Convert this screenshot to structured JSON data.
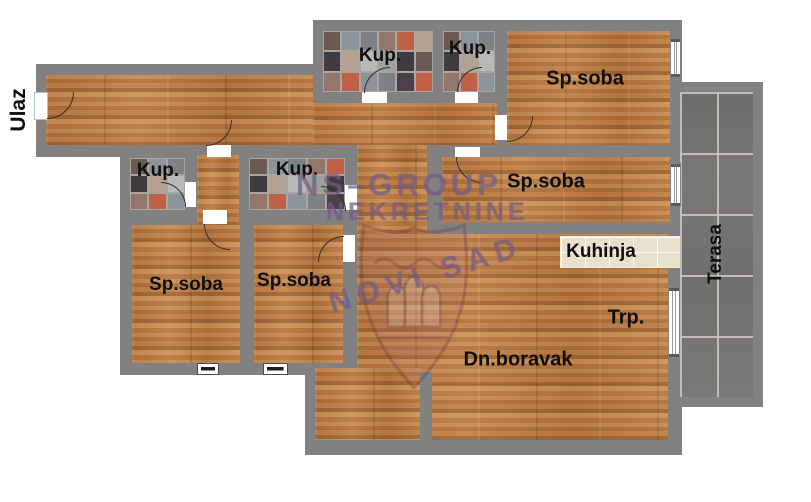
{
  "plan": {
    "labels": {
      "entrance": "Ulaz",
      "bath_top_left": "Kup.",
      "bath_top_right": "Kup.",
      "bedroom_top_right": "Sp.soba",
      "bath_mid_left": "Kup.",
      "bath_mid_center": "Kup.",
      "bedroom_mid_right": "Sp.soba",
      "kitchen": "Kuhinja",
      "dining": "Trp.",
      "living_room": "Dn.boravak",
      "bedroom_bottom_left": "Sp.soba",
      "bedroom_bottom_center": "Sp.soba",
      "terrace": "Terasa"
    },
    "watermark": {
      "line1": "NS–GROUP",
      "line2": "NEKRETNINE",
      "crest_text": "NOVI SAD"
    },
    "colors": {
      "wall": "#818181",
      "wood_floor": "#b97c49",
      "kitchen_tile": "#e8e1cd",
      "terrace_tile": "#757371",
      "label_text": "#0f0f0f",
      "watermark": "#7a6290",
      "bath_palette": [
        "#6a5a52",
        "#b7bab6",
        "#4a4148",
        "#c06046",
        "#8b949a",
        "#9aa39b",
        "#3f3a40",
        "#b3a292",
        "#7e8284",
        "#93766b"
      ]
    }
  }
}
